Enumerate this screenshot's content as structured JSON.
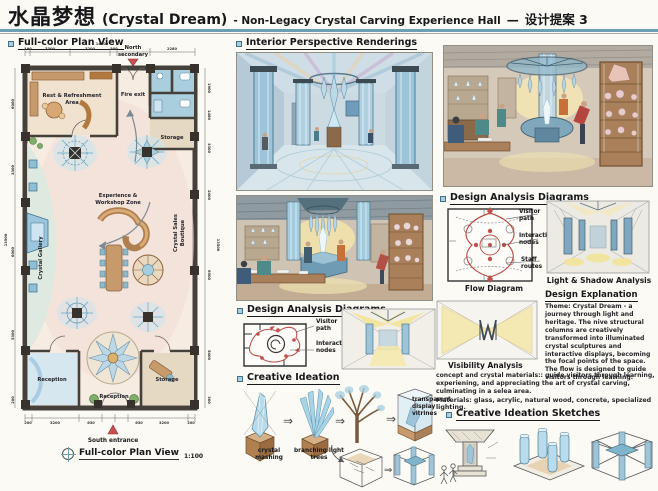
{
  "header": {
    "title_zh": "水晶梦想",
    "title_en": "(Crystal Dream)",
    "title_sub": "- Non-Legacy Crystal Carving Experience Hall",
    "title_dash": "—",
    "title_proposal": "设计提案 3"
  },
  "glyphs": {
    "arrow_right": "⇒",
    "arrow_curve": "↳"
  },
  "colors": {
    "accent_rule": "#6d9fb2",
    "bullet_fill": "#a8cfdd",
    "flow_red": "#c0504d",
    "entrance_red": "#c94f52",
    "crystal_blue": "#a3cbde",
    "wood_tan": "#c79a6c",
    "light_yellow": "#f4e8a8"
  },
  "plan": {
    "header": "Full-color Plan View",
    "north_line1": "North",
    "north_line2": "secondary",
    "south_label": "South entrance",
    "caption": "Full-color Plan View",
    "scale": "1:100",
    "rooms": {
      "rest_area_1": "Rest & Refreshment",
      "rest_area_2": "Area",
      "fire_exit": "Fire exit",
      "storage_top": "Storage",
      "experience_1": "Experience &",
      "experience_2": "Workshop Zone",
      "crystal_gallery": "Crystal Gallery",
      "sales_1": "Crystal Sales",
      "sales_2": "Boutique",
      "reception_left": "Reception",
      "reception_bottom": "Reception",
      "storage_bottom": "Storage"
    },
    "dims": {
      "top_total": "14500",
      "top": [
        "190",
        "3300",
        "3200",
        "300",
        "2280"
      ],
      "bottom": [
        "200",
        "3200",
        "630",
        "630",
        "3200",
        "200"
      ],
      "left": [
        "6000",
        "3300",
        "6000",
        "5300",
        "200"
      ],
      "left_total": "13500",
      "right": [
        "1900",
        "1480",
        "3300",
        "2400",
        "6500",
        "5400",
        "300"
      ],
      "right_total": "13500"
    }
  },
  "middle": {
    "renderings_header": "Interior Perspective Renderings",
    "analysis_header": "Design Analysis Diagrams",
    "visitor_path": "Visitor path",
    "interactive_nodes": "Interactive nodes",
    "ideation_header": "Creative Ideation",
    "label_crystal": "crystal mashing",
    "label_branching": "branching light trees",
    "label_vitrines": "transparent display vitrines"
  },
  "right": {
    "analysis_header": "Design Analysis Diagrams",
    "visitor_path": "Visitor path",
    "interactive_nodes": "Interactive nodes",
    "staff_routes": "Staff routes",
    "flow_caption": "Flow Diagram",
    "light_caption": "Light & Shadow Analysis",
    "explanation_header": "Design Explanation",
    "explanation_text": "Theme: Crystal Dream - a journey through light and heritage. The nive structural columns are creatively transformed into illuminated crystal sculptures and interactive displays, becoming the focal points of the space. The flow is designed to guide visitors through learning.",
    "visibility_caption": "Visibility Analysis",
    "concept_text": "concept and crystal materials:: guide visitors through learning, experiening, and appreciating the art of crystal carving, culminating in a selea area.",
    "materials_text": "Materials: glass, acrylic, natural wood, concrete, specialized lighting.",
    "sketches_header": "Creative Ideation Sketches"
  }
}
